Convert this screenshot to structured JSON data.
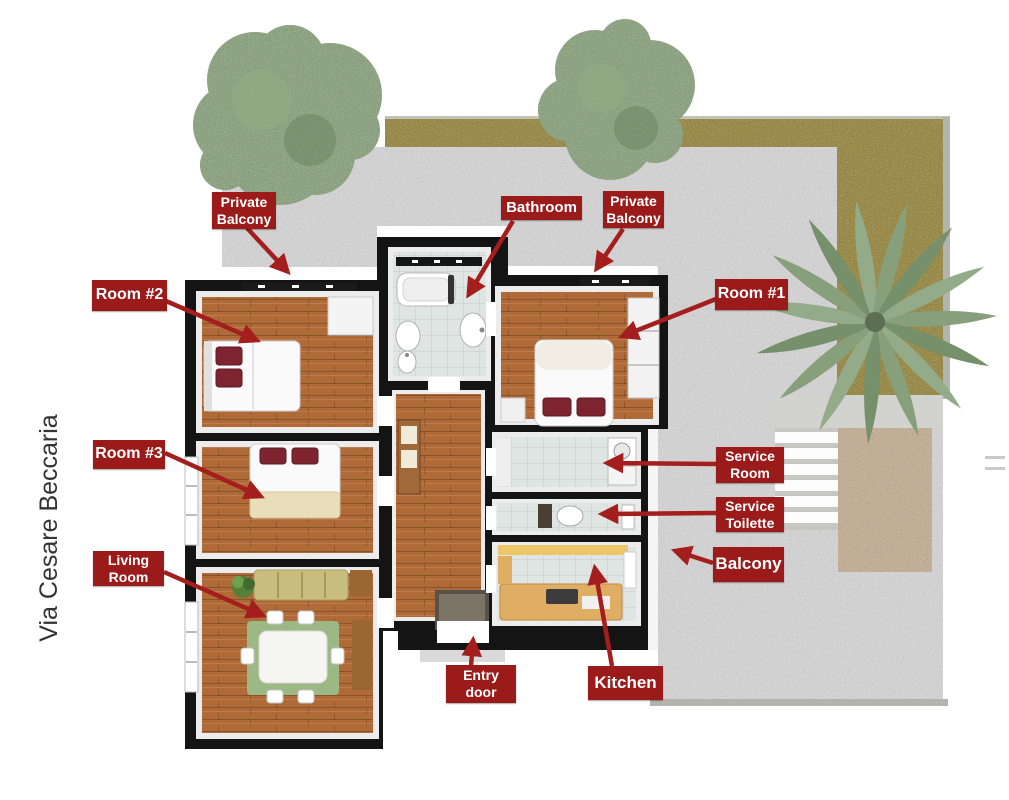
{
  "street_label": "Via Cesare Beccaria",
  "labels": {
    "private_balcony_left": "Private\nBalcony",
    "bathroom": "Bathroom",
    "private_balcony_right": "Private\nBalcony",
    "room_2": "Room #2",
    "room_1": "Room #1",
    "room_3": "Room #3",
    "living_room": "Living\nRoom",
    "service_room": "Service\nRoom",
    "service_toilette": "Service\nToilette",
    "balcony": "Balcony",
    "entry_door": "Entry\ndoor",
    "kitchen": "Kitchen"
  },
  "colors": {
    "label_bg": "#9b1b1b",
    "label_text": "#ffffff",
    "arrow": "#a51e1e",
    "street_text": "#333333",
    "wall": "#141414",
    "wood": "#b06a38",
    "tile": "#dfe5e3",
    "gravel": "#d9d9d9",
    "grass": "#8d7a24",
    "mat": "#c2a989",
    "pillow": "#7e2430",
    "rug": "#9cb884",
    "sofa": "#c9bd7e",
    "counter": "#dfae63",
    "counter_top": "#ecc769",
    "tree": "#7d9a6e",
    "palm": "#87a07b"
  }
}
